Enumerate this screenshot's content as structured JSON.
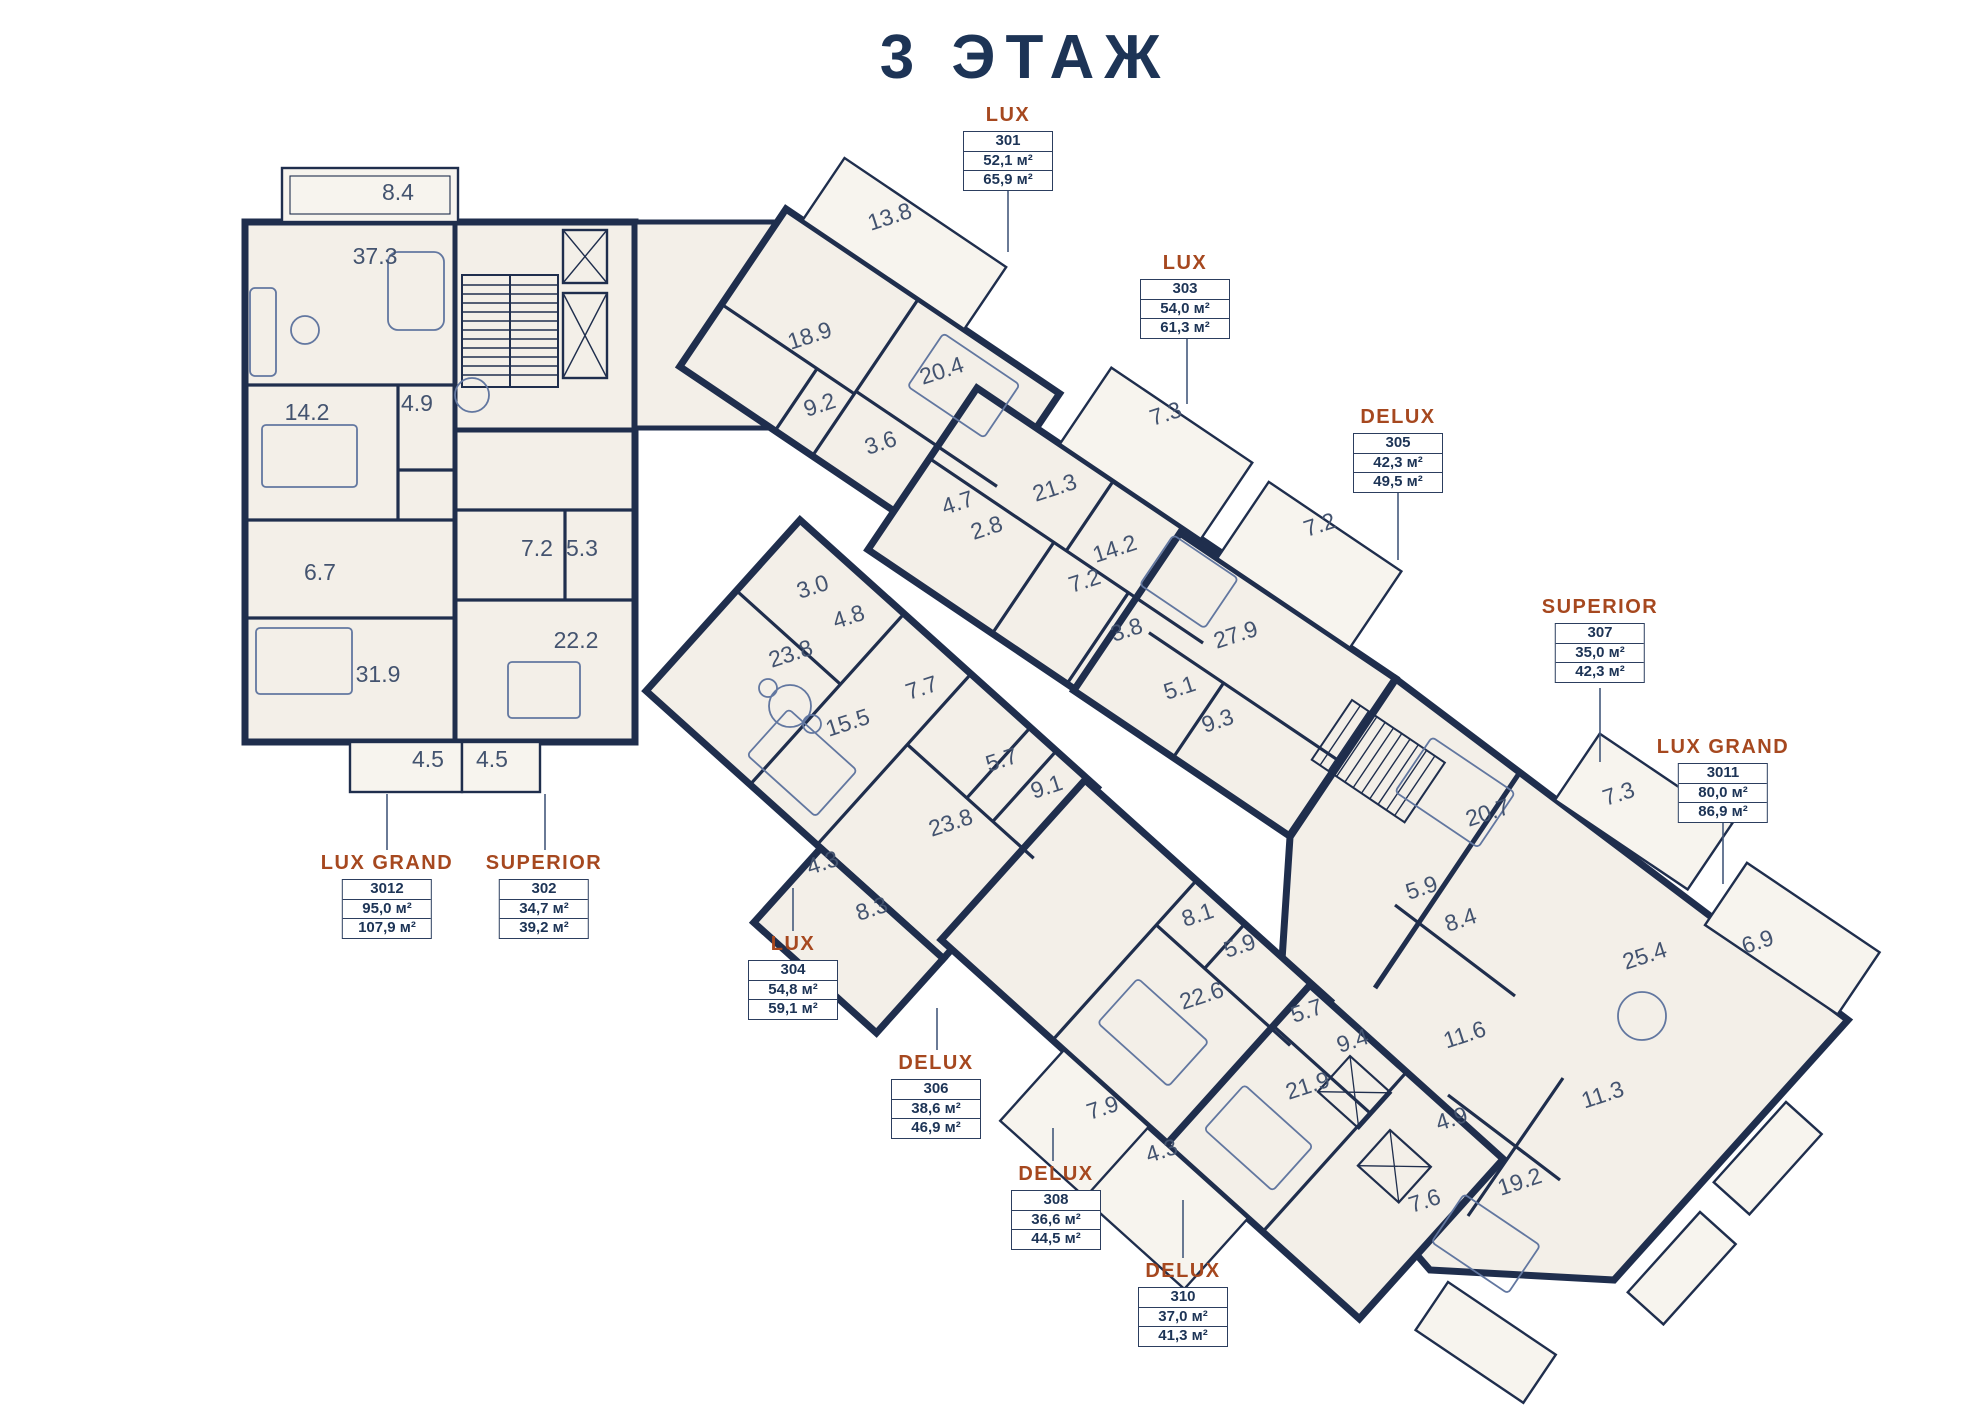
{
  "title": "3 ЭТАЖ",
  "palette": {
    "navy_walls": "#1f2e4d",
    "accent_type": "#a6481f",
    "room_fill": "#f3efe8",
    "balcony_fill": "#f7f4ee",
    "label_text": "#1d3456",
    "room_number_text": "#43536f"
  },
  "apartments": [
    {
      "type": "LUX",
      "number": "301",
      "area_living": "52,1 м²",
      "area_total": "65,9 м²",
      "x": 1008,
      "y": 104
    },
    {
      "type": "LUX",
      "number": "303",
      "area_living": "54,0 м²",
      "area_total": "61,3 м²",
      "x": 1185,
      "y": 252
    },
    {
      "type": "DELUX",
      "number": "305",
      "area_living": "42,3 м²",
      "area_total": "49,5 м²",
      "x": 1398,
      "y": 406
    },
    {
      "type": "SUPERIOR",
      "number": "307",
      "area_living": "35,0 м²",
      "area_total": "42,3 м²",
      "x": 1600,
      "y": 596
    },
    {
      "type": "LUX GRAND",
      "number": "3011",
      "area_living": "80,0 м²",
      "area_total": "86,9 м²",
      "x": 1723,
      "y": 736
    },
    {
      "type": "LUX GRAND",
      "number": "3012",
      "area_living": "95,0 м²",
      "area_total": "107,9 м²",
      "x": 387,
      "y": 852
    },
    {
      "type": "SUPERIOR",
      "number": "302",
      "area_living": "34,7 м²",
      "area_total": "39,2 м²",
      "x": 544,
      "y": 852
    },
    {
      "type": "LUX",
      "number": "304",
      "area_living": "54,8 м²",
      "area_total": "59,1 м²",
      "x": 793,
      "y": 933
    },
    {
      "type": "DELUX",
      "number": "306",
      "area_living": "38,6 м²",
      "area_total": "46,9 м²",
      "x": 936,
      "y": 1052
    },
    {
      "type": "DELUX",
      "number": "308",
      "area_living": "36,6 м²",
      "area_total": "44,5 м²",
      "x": 1056,
      "y": 1163
    },
    {
      "type": "DELUX",
      "number": "310",
      "area_living": "37,0 м²",
      "area_total": "41,3 м²",
      "x": 1183,
      "y": 1260
    }
  ],
  "rooms": [
    {
      "area": "8.4",
      "x": 398,
      "y": 200,
      "r": 0
    },
    {
      "area": "37.3",
      "x": 375,
      "y": 264,
      "r": 0
    },
    {
      "area": "14.2",
      "x": 307,
      "y": 420,
      "r": 0
    },
    {
      "area": "4.9",
      "x": 417,
      "y": 411,
      "r": 0
    },
    {
      "area": "6.7",
      "x": 320,
      "y": 580,
      "r": 0
    },
    {
      "area": "31.9",
      "x": 378,
      "y": 682,
      "r": 0
    },
    {
      "area": "7.2",
      "x": 537,
      "y": 556,
      "r": 0
    },
    {
      "area": "5.3",
      "x": 582,
      "y": 556,
      "r": 0
    },
    {
      "area": "22.2",
      "x": 576,
      "y": 648,
      "r": 0
    },
    {
      "area": "4.5",
      "x": 428,
      "y": 767,
      "r": 0
    },
    {
      "area": "4.5",
      "x": 492,
      "y": 767,
      "r": 0
    },
    {
      "area": "13.8",
      "x": 892,
      "y": 224,
      "r": -18
    },
    {
      "area": "18.9",
      "x": 812,
      "y": 343,
      "r": -18
    },
    {
      "area": "20.4",
      "x": 944,
      "y": 378,
      "r": -18
    },
    {
      "area": "9.2",
      "x": 822,
      "y": 412,
      "r": -18
    },
    {
      "area": "3.6",
      "x": 883,
      "y": 450,
      "r": -18
    },
    {
      "area": "7.3",
      "x": 1168,
      "y": 421,
      "r": -18
    },
    {
      "area": "21.3",
      "x": 1057,
      "y": 495,
      "r": -18
    },
    {
      "area": "4.7",
      "x": 960,
      "y": 510,
      "r": -18
    },
    {
      "area": "2.8",
      "x": 989,
      "y": 535,
      "r": -18
    },
    {
      "area": "14.2",
      "x": 1117,
      "y": 556,
      "r": -18
    },
    {
      "area": "7.2",
      "x": 1087,
      "y": 588,
      "r": -18
    },
    {
      "area": "3.8",
      "x": 1129,
      "y": 637,
      "r": -18
    },
    {
      "area": "7.2",
      "x": 1322,
      "y": 532,
      "r": -18
    },
    {
      "area": "27.9",
      "x": 1238,
      "y": 642,
      "r": -18
    },
    {
      "area": "5.1",
      "x": 1182,
      "y": 695,
      "r": -18
    },
    {
      "area": "9.3",
      "x": 1220,
      "y": 728,
      "r": -18
    },
    {
      "area": "3.0",
      "x": 815,
      "y": 594,
      "r": -18
    },
    {
      "area": "4.8",
      "x": 851,
      "y": 624,
      "r": -18
    },
    {
      "area": "23.8",
      "x": 793,
      "y": 661,
      "r": -18
    },
    {
      "area": "7.7",
      "x": 924,
      "y": 695,
      "r": -18
    },
    {
      "area": "15.5",
      "x": 850,
      "y": 730,
      "r": -18
    },
    {
      "area": "5.7",
      "x": 1004,
      "y": 767,
      "r": -18
    },
    {
      "area": "9.1",
      "x": 1049,
      "y": 794,
      "r": -18
    },
    {
      "area": "23.8",
      "x": 953,
      "y": 830,
      "r": -18
    },
    {
      "area": "4.3",
      "x": 825,
      "y": 870,
      "r": -18
    },
    {
      "area": "8.3",
      "x": 874,
      "y": 916,
      "r": -18
    },
    {
      "area": "8.1",
      "x": 1200,
      "y": 922,
      "r": -18
    },
    {
      "area": "5.9",
      "x": 1242,
      "y": 953,
      "r": -18
    },
    {
      "area": "22.6",
      "x": 1204,
      "y": 1003,
      "r": -18
    },
    {
      "area": "5.7",
      "x": 1309,
      "y": 1018,
      "r": -18
    },
    {
      "area": "9.4",
      "x": 1355,
      "y": 1048,
      "r": -18
    },
    {
      "area": "21.9",
      "x": 1310,
      "y": 1093,
      "r": -18
    },
    {
      "area": "7.9",
      "x": 1105,
      "y": 1115,
      "r": -18
    },
    {
      "area": "4.3",
      "x": 1164,
      "y": 1158,
      "r": -18
    },
    {
      "area": "11.6",
      "x": 1467,
      "y": 1042,
      "r": -18
    },
    {
      "area": "4.9",
      "x": 1454,
      "y": 1126,
      "r": -18
    },
    {
      "area": "7.6",
      "x": 1427,
      "y": 1208,
      "r": -18
    },
    {
      "area": "19.2",
      "x": 1522,
      "y": 1189,
      "r": -18
    },
    {
      "area": "11.3",
      "x": 1605,
      "y": 1102,
      "r": -18
    },
    {
      "area": "7.3",
      "x": 1621,
      "y": 801,
      "r": -18
    },
    {
      "area": "20.7",
      "x": 1490,
      "y": 820,
      "r": -18
    },
    {
      "area": "5.9",
      "x": 1424,
      "y": 895,
      "r": -18
    },
    {
      "area": "8.4",
      "x": 1463,
      "y": 927,
      "r": -18
    },
    {
      "area": "25.4",
      "x": 1647,
      "y": 963,
      "r": -18
    },
    {
      "area": "6.9",
      "x": 1760,
      "y": 949,
      "r": -18
    }
  ]
}
